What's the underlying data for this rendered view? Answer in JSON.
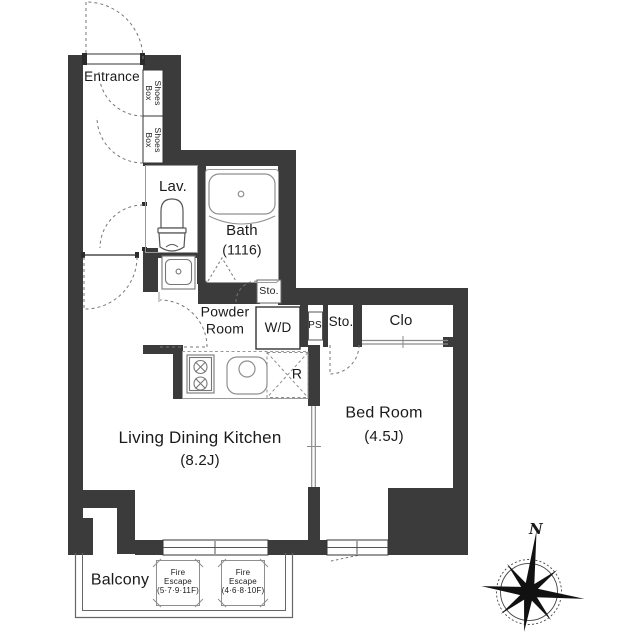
{
  "floorplan": {
    "rooms": {
      "entrance": {
        "label": "Entrance"
      },
      "shoes_box_upper": {
        "label": "Shoes\nBox"
      },
      "shoes_box_lower": {
        "label": "Shoes\nBox"
      },
      "lavatory": {
        "label": "Lav."
      },
      "bath": {
        "name": "Bath",
        "size": "(1116)"
      },
      "powder_room": {
        "label": "Powder\nRoom"
      },
      "washer_dryer": {
        "label": "W/D"
      },
      "storage_by_bath": {
        "label": "Sto."
      },
      "pipe_space": {
        "label": "PS"
      },
      "storage": {
        "label": "Sto."
      },
      "closet": {
        "label": "Clo"
      },
      "bedroom": {
        "name": "Bed Room",
        "size": "(4.5J)"
      },
      "living_dining_kitchen": {
        "name": "Living Dining Kitchen",
        "size": "(8.2J)"
      },
      "refrigerator_space": {
        "label": "R"
      },
      "balcony": {
        "label": "Balcony"
      },
      "fire_escape_upper_floors": {
        "label": "Fire\nEscape\n(5·7·9·11F)"
      },
      "fire_escape_lower_floors": {
        "label": "Fire\nEscape\n(4·6·8·10F)"
      }
    },
    "compass": {
      "north": "N"
    },
    "colors": {
      "wall": "#3b3b3b",
      "outline": "#8f8f8f",
      "text": "#1a1a1a",
      "background": "#ffffff"
    }
  }
}
